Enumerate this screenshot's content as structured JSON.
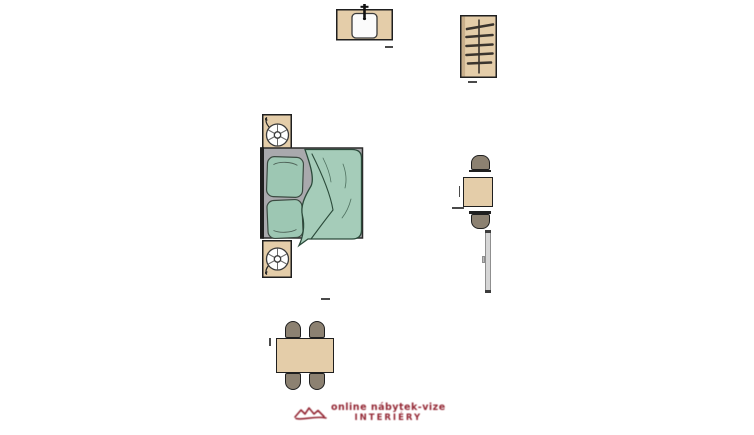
{
  "scene": {
    "type": "bedroom-floorplan",
    "background": "#ffffff",
    "colors": {
      "wood": "#e4cda9",
      "wood_dark": "#c9af8b",
      "outline": "#1f1f1f",
      "mattress": "#a9a9ad",
      "mattress_edge": "#2a2a2a",
      "blanket": "#a5ccb9",
      "blanket_line": "#2b4a3a",
      "pillow": "#9dc7b3",
      "seat": "#8c8171",
      "basin": "#fbfbfb",
      "radiator": "#d6d6d6",
      "radiator_edge": "#8f8f8f",
      "metal": "#3a342e",
      "watermark": "#8e1c29"
    },
    "items": [
      "sink unit with faucet",
      "wardrobe with clothes rail and hangers",
      "nightstand with lamp (top)",
      "double bed with two pillows and duvet",
      "nightstand with lamp (bottom)",
      "side table with two chairs",
      "wall radiator",
      "dining table with four chairs"
    ]
  },
  "watermark": {
    "line1": "online nábytek-vize",
    "line2": "INTERIÉRY"
  }
}
